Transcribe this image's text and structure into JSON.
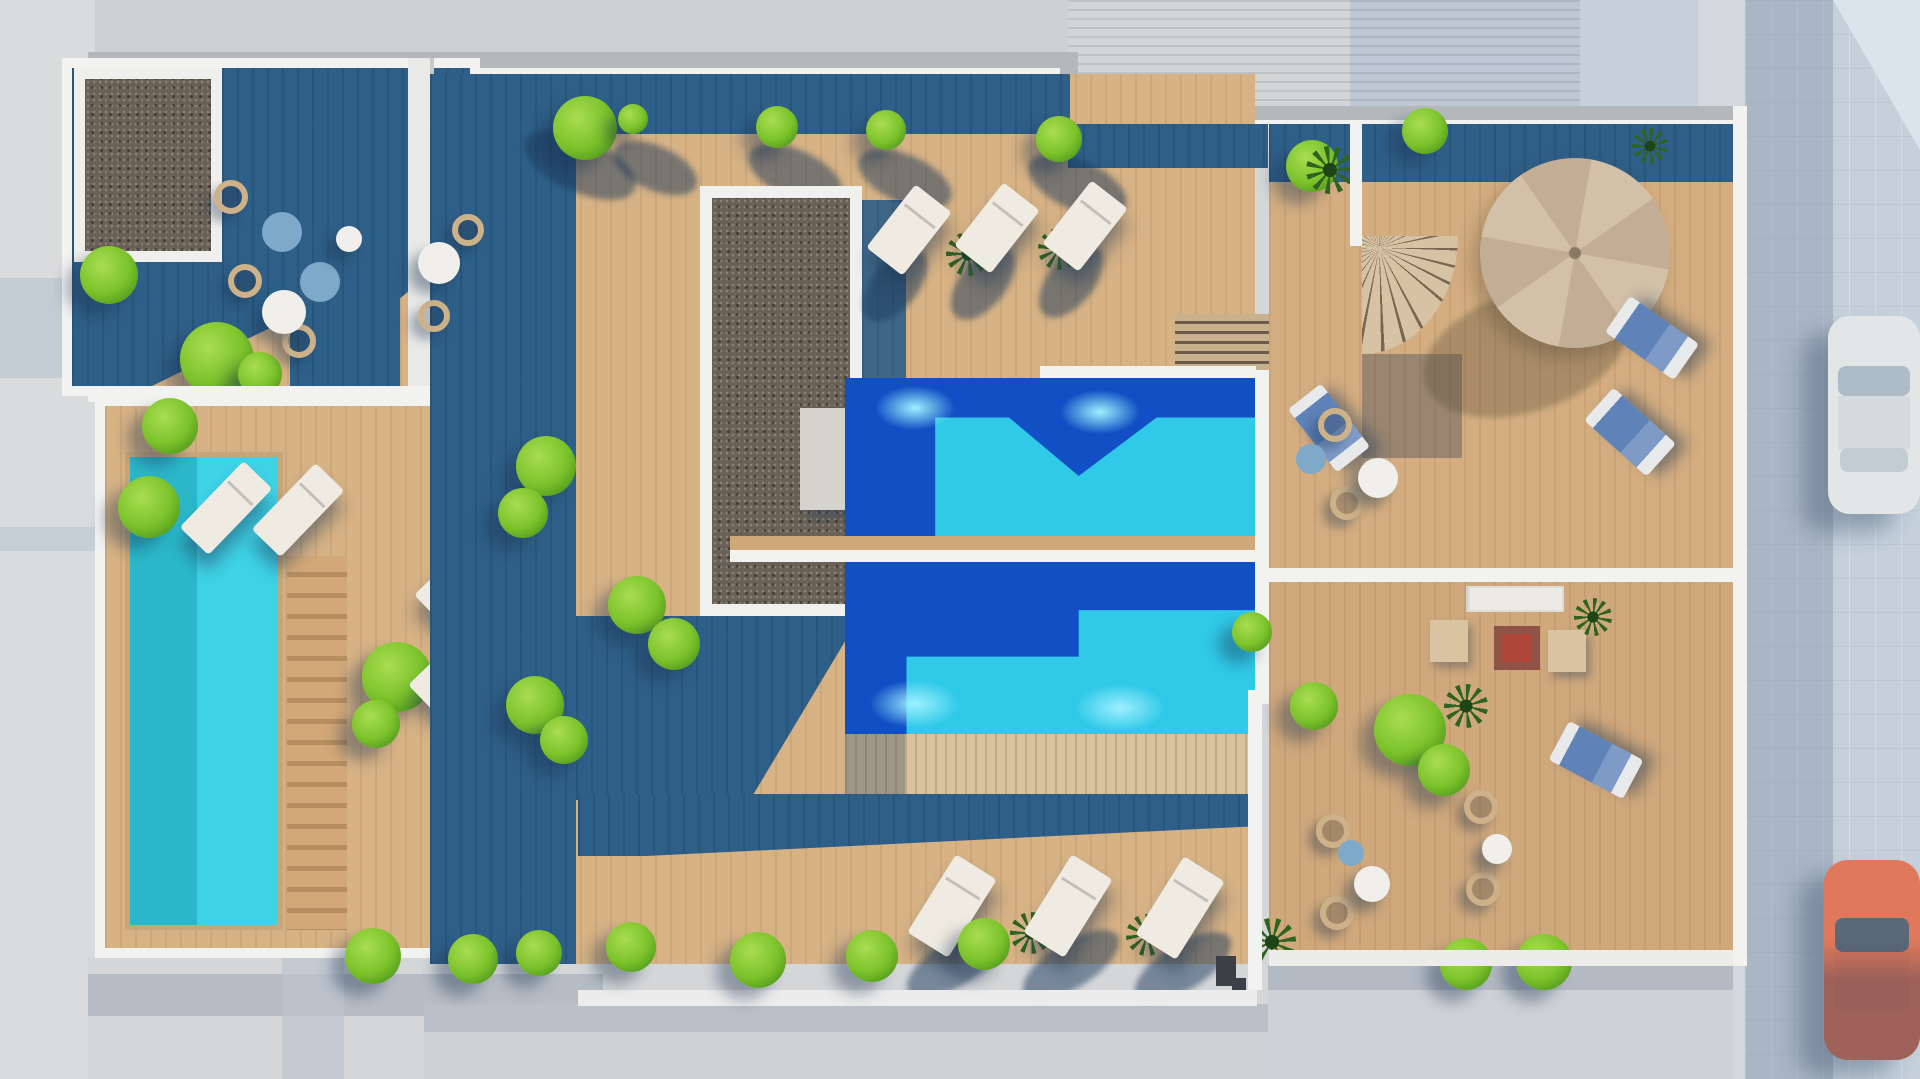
{
  "meta": {
    "image_type": "3d-architectural-render",
    "view": "aerial-top-down",
    "subject": "rooftop terrace of an apartment building with swimming pools, wooden sun decks, loungers and planting, bordered by streets"
  },
  "palette": {
    "street_gray": "#d4d6d8",
    "street_top": "#cdd0d3",
    "street_shadow": "#b6bcc4",
    "left_strip": "#dadbdd",
    "pavement_blue": "#c5d0db",
    "sidewalk": "#d2d8de",
    "roof_tile": "#d2d4d6",
    "roof_tile_blue": "#bac7d4",
    "parapet_white": "#f2f2f0",
    "wall_gray": "#b5b8bb",
    "wood_sun": "#d6b285",
    "wood_pale": "#dcb990",
    "wood_steps": "#c9a272",
    "wood_dark": "#4a5468",
    "deck_shadow": "#2e5f88",
    "gravel": "#696056",
    "pool_deep": "#1150c4",
    "pool_bright": "#30c9e8",
    "pool_teal": "#2bb7c9",
    "pool_teal2": "#3ed2e6",
    "pool_glow": "#9ef0ff",
    "bush": "#7cc32b",
    "bush_light": "#a9dd52",
    "bush_dark": "#4e961c",
    "palm": "#2f6322",
    "lounger": "#efebe2",
    "cushion_blue": "#5f82b8",
    "cushion_teal": "#7ea9c8",
    "wicker": "#cdb189",
    "table_white": "#f0efec",
    "umbrella": "#d2c0a8",
    "umbrella2": "#c1ae94",
    "blue_wall": "#3b7cb1",
    "plank_wall": "#d9c29c",
    "sofa_table_red": "#b0483a",
    "car_orange": "#e0795b",
    "car_white": "#e3e6e7"
  },
  "scene": {
    "areas": [
      "top-left terrace with gravel skylight and seating",
      "left terrace with private pool and wooden stairs",
      "central sun deck with long gravel skylight",
      "twin community pools with glass divider",
      "lower balcony terrace with loungers",
      "right terrace with parasol and spiral staircase",
      "bottom-right terrace with lounge sofa and wicker chairs",
      "tiled roof of adjacent building",
      "streets on left, bottom and right"
    ],
    "pools": [
      {
        "id": "left-pool",
        "shape": "rectangle",
        "tones": [
          "teal",
          "turquoise"
        ]
      },
      {
        "id": "upper-pool",
        "shape": "rectangle",
        "tones": [
          "deep-blue",
          "turquoise"
        ],
        "underwater_lights": 2
      },
      {
        "id": "lower-pool",
        "shape": "rectangle",
        "tones": [
          "deep-blue",
          "turquoise"
        ],
        "underwater_lights": 2
      }
    ],
    "furniture": {
      "white_sun_loungers": 10,
      "blue_cushion_loungers": 4,
      "wicker_chairs": 11,
      "round_tables": 7,
      "parasol": 1,
      "spiral_staircase": 1,
      "straight_stairs": 2,
      "lounge_sofa_set": 1
    },
    "vegetation": {
      "bushes": 30,
      "palm_plants": 10
    },
    "vehicles": [
      {
        "type": "car",
        "color": "white",
        "location": "right street, upper"
      },
      {
        "type": "car",
        "color": "orange",
        "location": "right street, lower"
      }
    ]
  }
}
